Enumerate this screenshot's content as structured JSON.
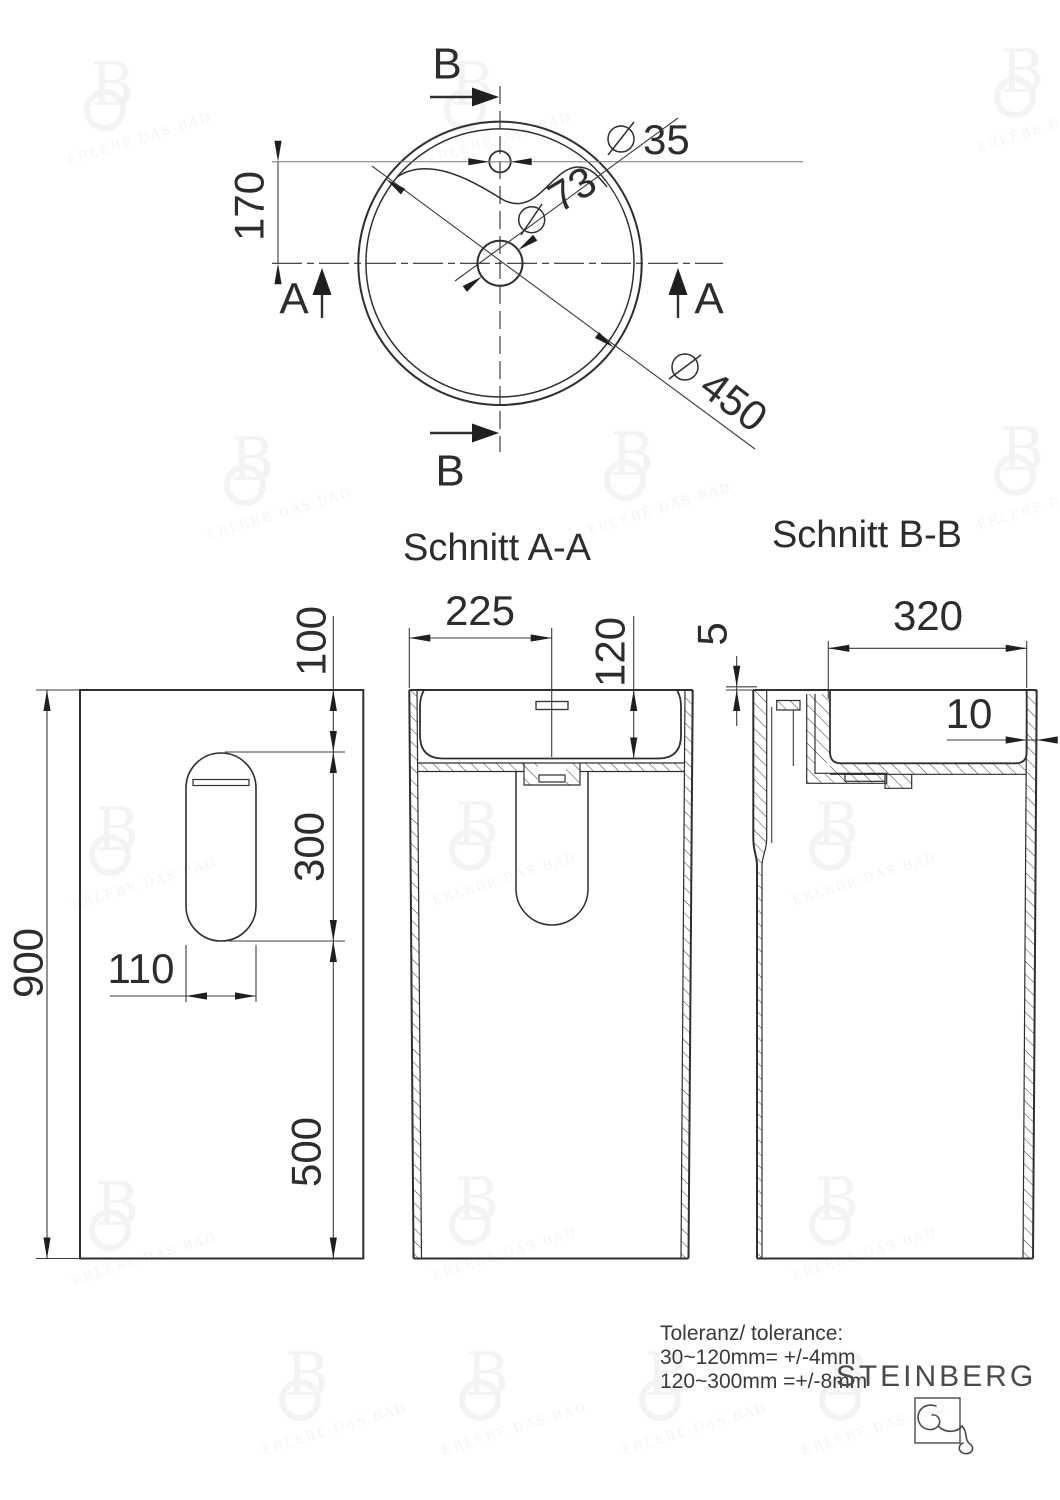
{
  "top_view": {
    "section_label_a": "A",
    "section_label_b": "B",
    "dim_170": "170",
    "dia_35": "35",
    "dia_73": "73",
    "dia_450": "450"
  },
  "section_aa": {
    "title": "Schnitt A-A",
    "dim_225": "225",
    "dim_120": "120"
  },
  "section_bb": {
    "title": "Schnitt B-B",
    "dim_320": "320",
    "dim_5": "5",
    "dim_10": "10"
  },
  "rear_view": {
    "dim_900": "900",
    "dim_100": "100",
    "dim_300": "300",
    "dim_500": "500",
    "dim_110": "110"
  },
  "tolerance": {
    "line1": "Toleranz/ tolerance:",
    "line2": "30~120mm= +/-4mm",
    "line3": "120~300mm =+/-8mm"
  },
  "brand": {
    "name": "STEINBERG"
  },
  "watermark": {
    "letter": "B",
    "caption": "ERLEBE DAS BAD"
  },
  "colors": {
    "line": "#2f2f2f",
    "thin": "#3c3c3c",
    "brand": "#4a4a4a"
  }
}
